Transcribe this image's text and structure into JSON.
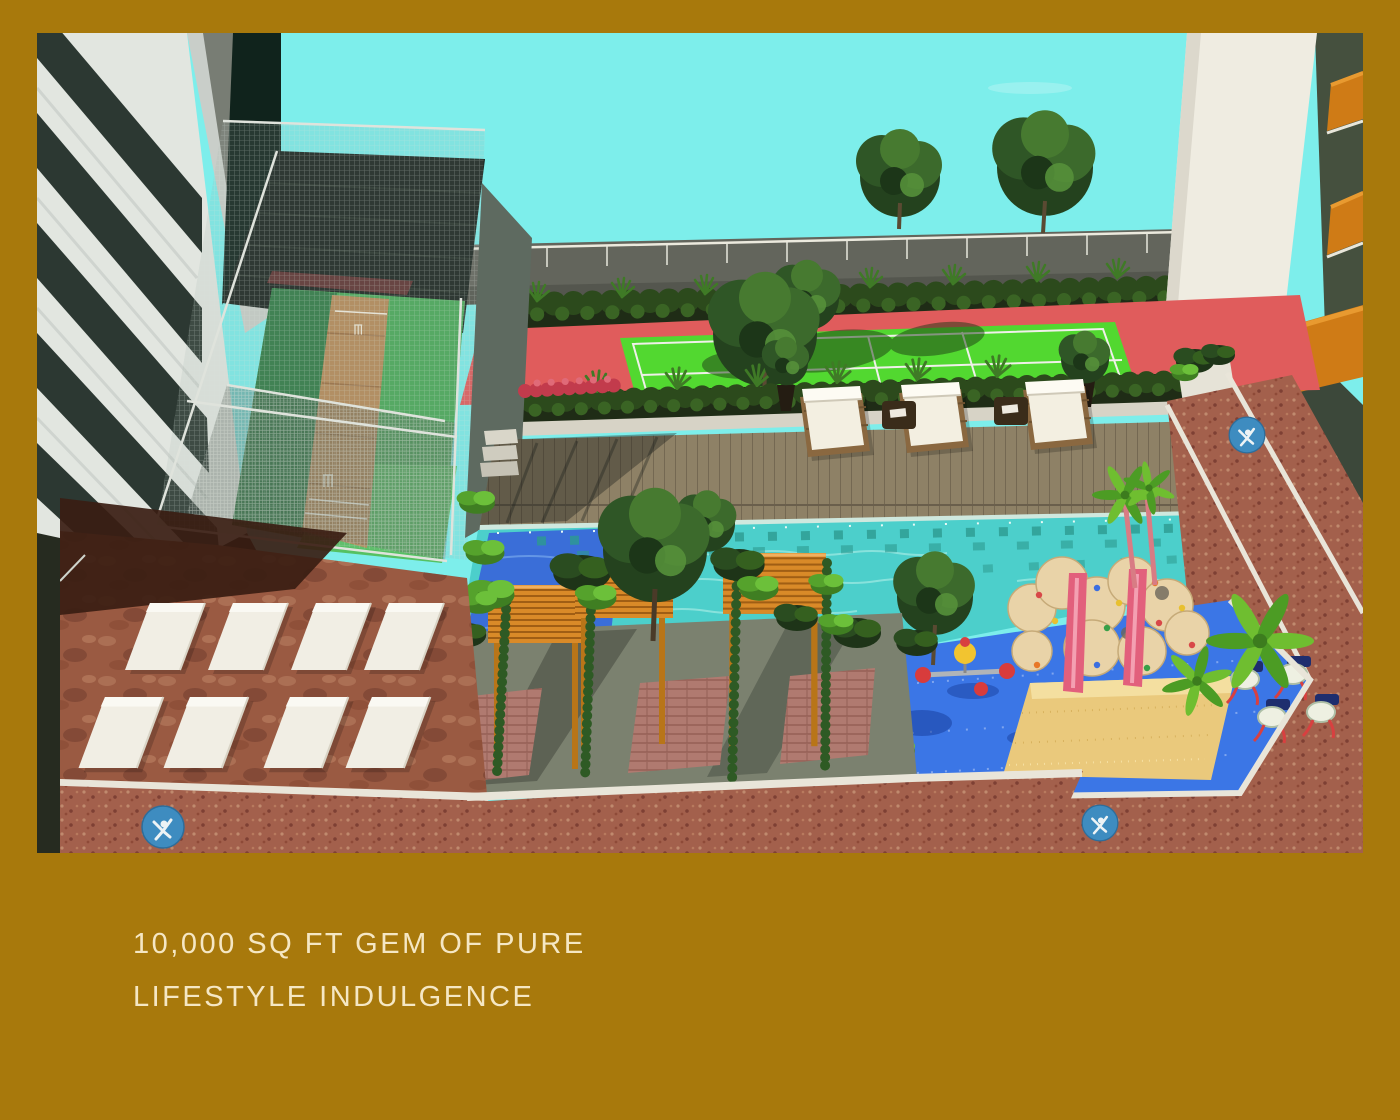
{
  "page": {
    "border_color": "#a8790c"
  },
  "caption": {
    "line1": "10,000 SQ FT GEM OF PURE",
    "line2": "LIFESTYLE INDULGENCE",
    "color": "#f5e7c4"
  },
  "palette": {
    "border_gold": "#a8790c",
    "caption_color": "#f5e7c4",
    "sky": "#7deeeb",
    "water": "#4ccfcb",
    "water_deep": "#3a6ed8",
    "deck_wood": "#8e8166",
    "court_green": "#52d830",
    "court_red": "#e05c5c",
    "cage_turf": "#48a858",
    "pitch_brown": "#b68a58",
    "play_blue": "#3b76e6",
    "sand": "#eac97c",
    "brick_path": "#a3604c",
    "terrace_stone": "#9a5a42",
    "pergola_wood": "#d98a28",
    "hedge_dark": "#1f2c16",
    "rock_beige": "#e9d3a8",
    "wall_white": "#efece1",
    "wall_olive": "#3c483a",
    "balcony_orange": "#cf7b16",
    "medallion_blue": "#3e8cc0",
    "facade_grey": "#e2e6e0",
    "glass_dark": "#2c3832",
    "curb_white": "#e9e5d9"
  },
  "scene": {
    "title": "Aerial 3D render of a residential podium amenity deck",
    "elements": [
      "sky",
      "left-residential-tower",
      "background-building",
      "right-residential-tower",
      "perimeter-parapet-railing",
      "perimeter-hedge",
      "tennis-court",
      "cricket-practice-net-enclosure",
      "timber-pool-deck",
      "sun-loungers",
      "swimming-pool",
      "pergola-seating-garden",
      "sunbathing-mats-terrace",
      "kids-play-area",
      "climbing-wall-with-slides",
      "sand-pit",
      "outdoor-gym-pods",
      "palm-landscaping",
      "walkway-medallions",
      "brick-walkways"
    ]
  }
}
